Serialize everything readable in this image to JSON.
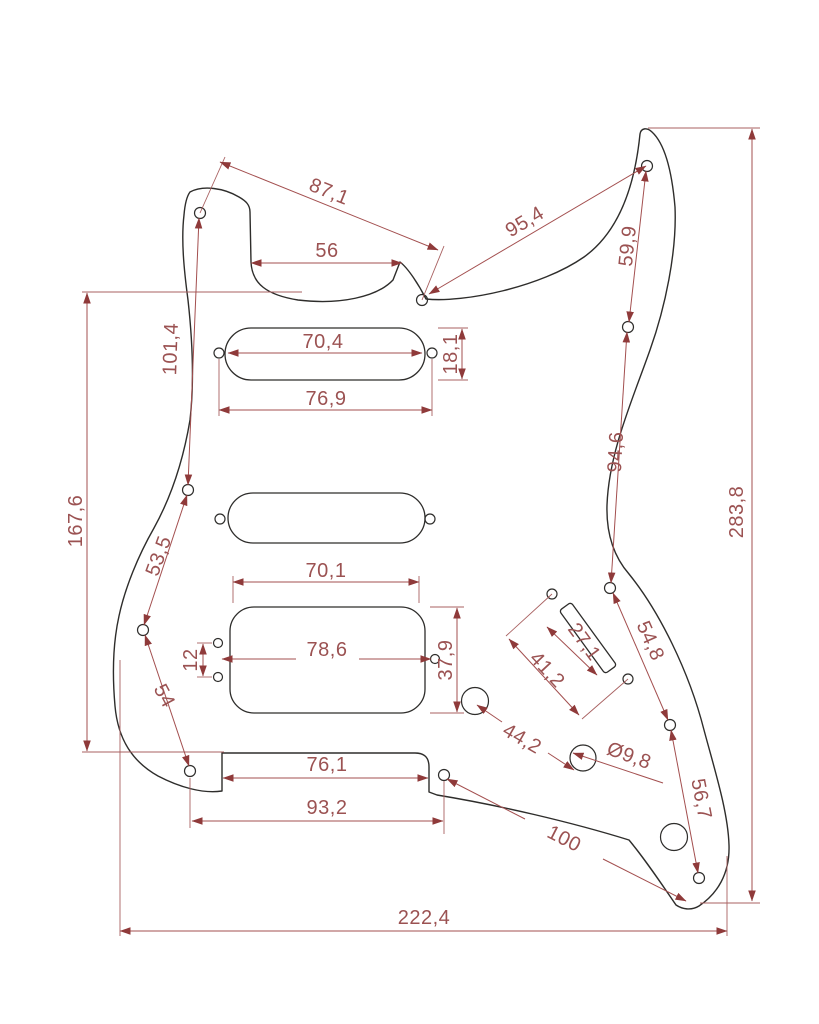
{
  "drawing": {
    "kind": "technical-dimension-drawing",
    "colors": {
      "outline": "#2e2d2b",
      "dimension_line": "#a34f4f",
      "dimension_text": "#9b5252",
      "arrow": "#8f3a3a",
      "background": "#ffffff"
    },
    "dims": {
      "d87_1": "87,1",
      "d95_4": "95,4",
      "d59_9": "59,9",
      "d56": "56",
      "d101_4": "101,4",
      "d167_6": "167,6",
      "d53_5": "53,5",
      "d54": "54",
      "d70_4": "70,4",
      "d18_1": "18,1",
      "d76_9": "76,9",
      "d70_1": "70,1",
      "d78_6": "78,6",
      "d37_9": "37,9",
      "d12": "12",
      "d27_1": "27,1",
      "d41_2": "41,2",
      "d94_6": "94,6",
      "d54_8": "54,8",
      "d283_8": "283,8",
      "d44_2": "44,2",
      "dia9_8": "Ø9,8",
      "d56_7": "56,7",
      "d100": "100",
      "d76_1": "76,1",
      "d93_2": "93,2",
      "d222_4": "222,4"
    }
  }
}
